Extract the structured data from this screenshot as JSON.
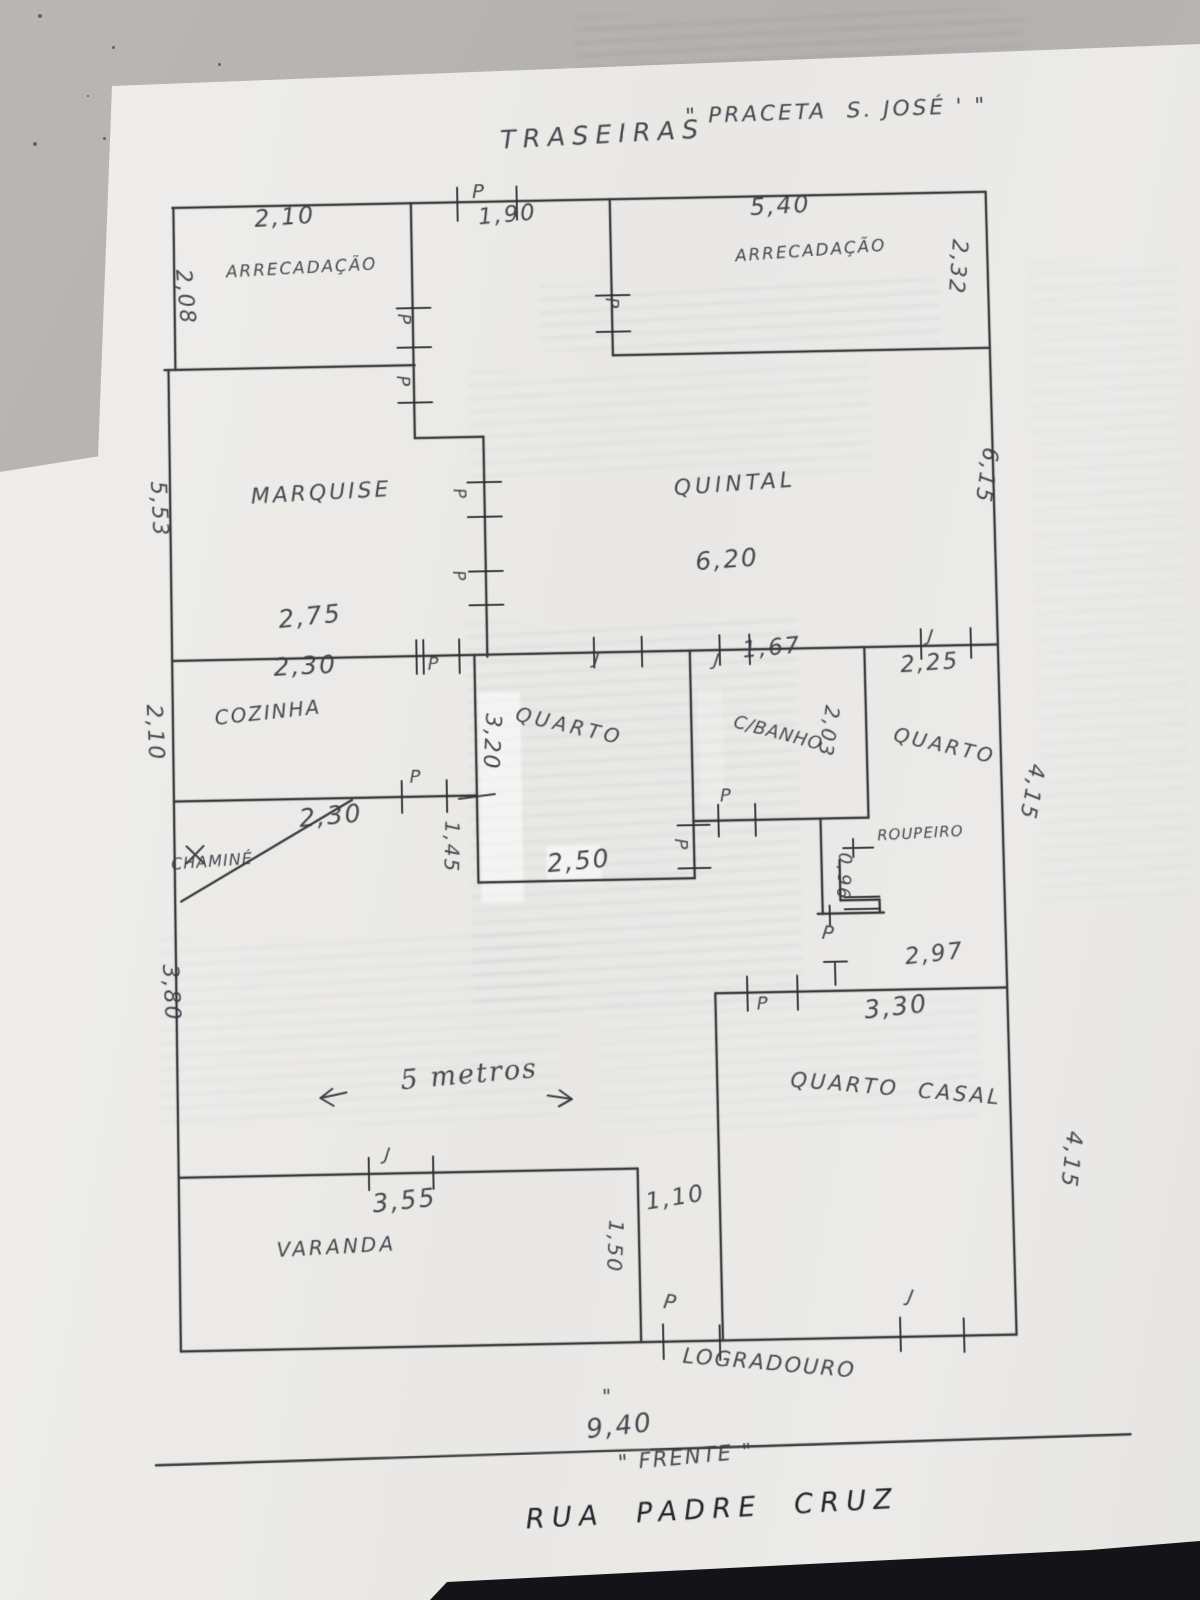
{
  "colors": {
    "paper": "#ebeae8",
    "background": "#b7b4b1",
    "pencil_lines": "#2c2c30",
    "handwriting_ink": "#383c44",
    "dark_ink": "#22242a",
    "table_dark_band": "#141418"
  },
  "labels": {
    "traseiras": "TRASEIRAS",
    "praceta": "\" PRACETA  S. JOSÉ ' \"",
    "p_top": "P",
    "dim_1_90": "1,90",
    "dim_2_10_top": "2,10",
    "arrecadacao_1": "ARRECADAÇÃO",
    "dim_2_08": "2,08",
    "dim_5_40": "5,40",
    "arrecadacao_2": "ARRECADAÇÃO",
    "dim_2_32": "2,32",
    "p_arr1_a": "P",
    "p_arr1_b": "P",
    "p_arr2": "P",
    "marquise": "MARQUISE",
    "dim_5_53": "5,53",
    "p_marq_a": "P",
    "p_marq_b": "P",
    "quintal": "QUINTAL",
    "dim_6_20": "6,20",
    "dim_6_15": "6,15",
    "dim_2_75": "2,75",
    "dim_2_30_wall": "2,30",
    "p_mid": "P",
    "j_mid": "J",
    "j_167": "J",
    "dim_1_67": "1,67",
    "j_225": "J",
    "dim_2_25": "2,25",
    "cozinha": "COZINHA",
    "dim_2_10_left": "2,10",
    "dim_2_30_cozinha": "2,30",
    "chamine": "CHAMINÉ",
    "p_cozinha": "P",
    "quarto_meio": "QUARTO",
    "dim_3_20": "3,20",
    "dim_1_45": "1,45",
    "dim_2_50_quarto": "2,50",
    "p_cbanho": "P",
    "p_quarto": "P",
    "cbanho": "C/BANHO",
    "dim_2_03": "2,03",
    "quarto_dir": "QUARTO",
    "dim_4_15_a": "4,15",
    "roupeiro": "ROUPEIRO",
    "dim_0_96": "0,96",
    "p_roupeiro": "P",
    "dim_2_97": "2,97",
    "p_sala": "P",
    "dim_3_30": "3,30",
    "quarto_casal": "QUARTO  CASAL",
    "dim_4_15_b": "4,15",
    "dim_3_80": "3,80",
    "cinco_metros": "5 metros",
    "j_varanda": "J",
    "dim_3_55": "3,55",
    "varanda": "VARANDA",
    "dim_1_50": "1,50",
    "dim_1_10": "1,10",
    "p_varanda": "P",
    "j_casal": "J",
    "logradouro": "LOGRADOURO",
    "ditto": "\"",
    "dim_9_40": "9,40",
    "frente": "\" FRENTE \"",
    "rua": "RUA  PADRE  CRUZ",
    "dim_2_50_frente": "2,50"
  }
}
